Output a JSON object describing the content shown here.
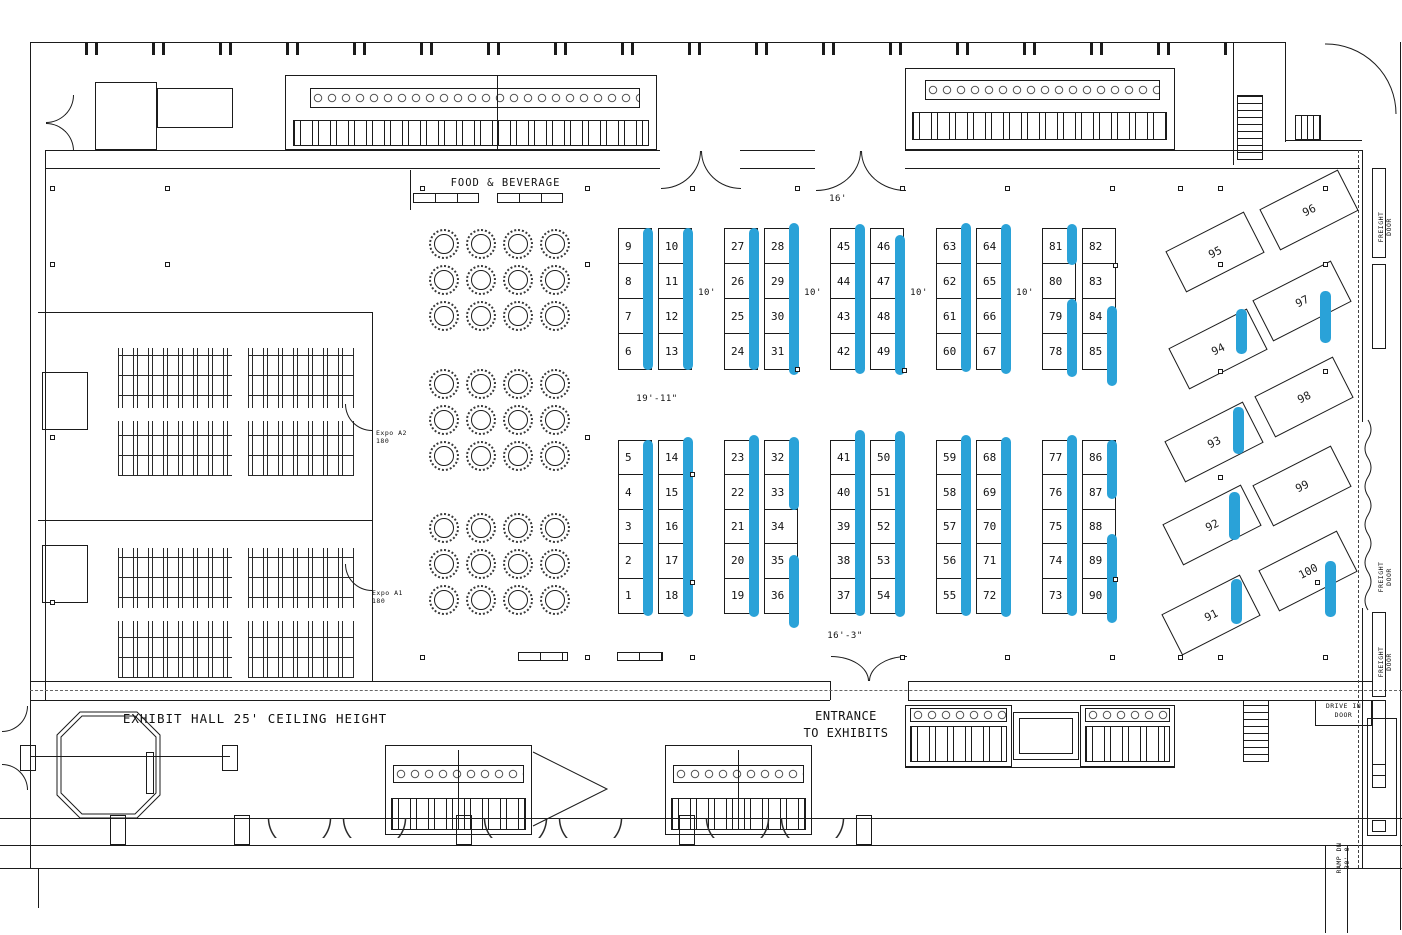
{
  "title": "Exhibit Hall Floor Plan",
  "colors": {
    "highlight": "#2aa2d8",
    "line": "#1b1b1b",
    "background": "#ffffff"
  },
  "labels": {
    "food_beverage": "FOOD & BEVERAGE",
    "exhibit_hall": "EXHIBIT HALL 25' CEILING HEIGHT",
    "entrance_line1": "ENTRANCE",
    "entrance_line2": "TO EXHIBITS",
    "drive_in_line1": "DRIVE IN",
    "drive_in_line2": "DOOR",
    "freight_line1": "FREIGHT",
    "freight_line2": "DOOR",
    "ramp_line1": "RAMP DN",
    "ramp_line2": "30'-0",
    "expo_a2_line1": "Expo A2",
    "expo_a2_line2": "180",
    "expo_a1_line1": "Expo A1",
    "expo_a1_line2": "180"
  },
  "dims": {
    "d16": "16'",
    "d10": "10'",
    "d19": "19'-11\"",
    "d163": "16'-3\""
  },
  "booths": {
    "top_blocks": [
      {
        "left": [
          "9",
          "8",
          "7",
          "6"
        ],
        "right": [
          "10",
          "11",
          "12",
          "13"
        ]
      },
      {
        "left": [
          "27",
          "26",
          "25",
          "24"
        ],
        "right": [
          "28",
          "29",
          "30",
          "31"
        ]
      },
      {
        "left": [
          "45",
          "44",
          "43",
          "42"
        ],
        "right": [
          "46",
          "47",
          "48",
          "49"
        ]
      },
      {
        "left": [
          "63",
          "62",
          "61",
          "60"
        ],
        "right": [
          "64",
          "65",
          "66",
          "67"
        ]
      },
      {
        "left": [
          "81",
          "80",
          "79",
          "78"
        ],
        "right": [
          "82",
          "83",
          "84",
          "85"
        ]
      }
    ],
    "bottom_blocks": [
      {
        "left": [
          "5",
          "4",
          "3",
          "2",
          "1"
        ],
        "right": [
          "14",
          "15",
          "16",
          "17",
          "18"
        ]
      },
      {
        "left": [
          "23",
          "22",
          "21",
          "20",
          "19"
        ],
        "right": [
          "32",
          "33",
          "34",
          "35",
          "36"
        ]
      },
      {
        "left": [
          "41",
          "40",
          "39",
          "38",
          "37"
        ],
        "right": [
          "50",
          "51",
          "52",
          "53",
          "54"
        ]
      },
      {
        "left": [
          "59",
          "58",
          "57",
          "56",
          "55"
        ],
        "right": [
          "68",
          "69",
          "70",
          "71",
          "72"
        ]
      },
      {
        "left": [
          "77",
          "76",
          "75",
          "74",
          "73"
        ],
        "right": [
          "86",
          "87",
          "88",
          "89",
          "90"
        ]
      }
    ],
    "angled": [
      "96",
      "95",
      "97",
      "94",
      "98",
      "93",
      "99",
      "92",
      "100",
      "91"
    ]
  },
  "highlights": {
    "top": [
      {
        "left": [
          [
            0,
            4
          ]
        ],
        "right": [
          [
            0,
            4
          ]
        ]
      },
      {
        "left": [
          [
            0,
            4
          ]
        ],
        "right": [
          [
            -0.15,
            4.15
          ]
        ]
      },
      {
        "left": [
          [
            -0.1,
            4.1
          ]
        ],
        "right": [
          [
            0.2,
            4.15
          ]
        ]
      },
      {
        "left": [
          [
            -0.15,
            4.05
          ]
        ],
        "right": [
          [
            -0.1,
            4.1
          ]
        ]
      },
      {
        "left": [
          [
            -0.1,
            1.05
          ],
          [
            2,
            4.2
          ]
        ],
        "right": [
          [
            2.2,
            4.45
          ]
        ]
      }
    ],
    "bottom": [
      {
        "left": [
          [
            0,
            5.05
          ]
        ],
        "right": [
          [
            -0.1,
            5.1
          ]
        ]
      },
      {
        "left": [
          [
            -0.15,
            5.1
          ]
        ],
        "right": [
          [
            -0.1,
            2
          ],
          [
            3.3,
            5.4
          ]
        ]
      },
      {
        "left": [
          [
            -0.3,
            5.05
          ]
        ],
        "right": [
          [
            -0.25,
            5.1
          ]
        ]
      },
      {
        "left": [
          [
            -0.15,
            5.05
          ]
        ],
        "right": [
          [
            -0.1,
            5.1
          ]
        ]
      },
      {
        "left": [
          [
            -0.15,
            5.05
          ]
        ],
        "right": [
          [
            0,
            1.7
          ],
          [
            2.7,
            5.25
          ]
        ]
      }
    ],
    "angled": [
      "97",
      "94",
      "93",
      "92",
      "91",
      "100"
    ]
  }
}
